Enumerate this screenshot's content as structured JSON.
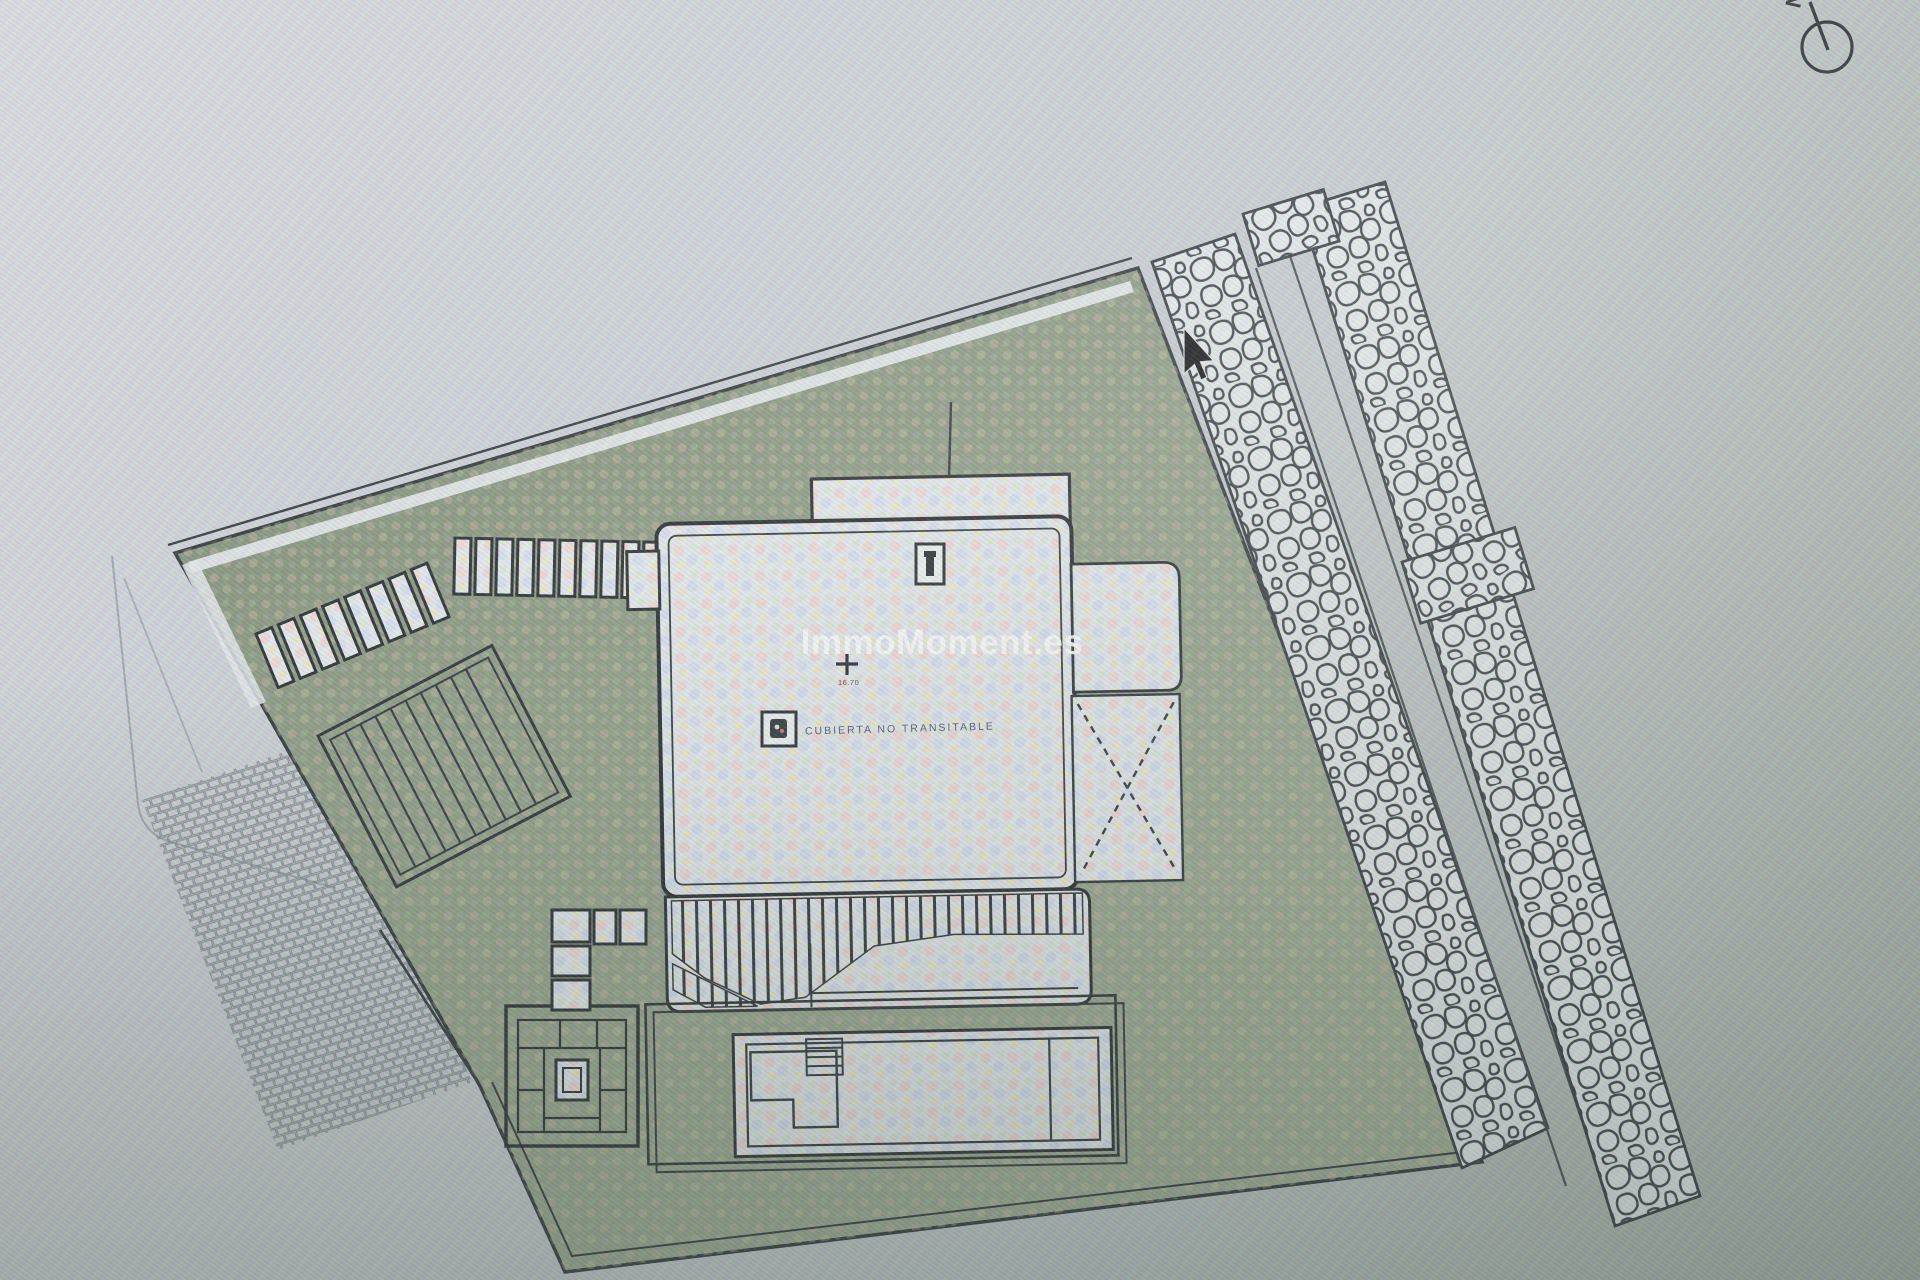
{
  "window": {
    "kind": "photo-of-screen architectural site plan"
  },
  "watermark": {
    "text": "ImmoMoment.es",
    "color": "#ffffff"
  },
  "plan": {
    "roof_label": "CUBIERTA NO TRANSITABLE",
    "roof_label_color": "#46506e",
    "elevation_marker": {
      "symbol": "+",
      "value": "16.70"
    },
    "compass": {
      "label": "N"
    }
  },
  "colors": {
    "ink": "#262d32",
    "plot_green_dark": "#76856e",
    "plot_green_light": "#9caa92",
    "paper": "#e4eaee",
    "background": "#c7ccd2"
  },
  "cursor": {
    "type": "arrow-pointer",
    "x": 1185,
    "y": 328
  }
}
